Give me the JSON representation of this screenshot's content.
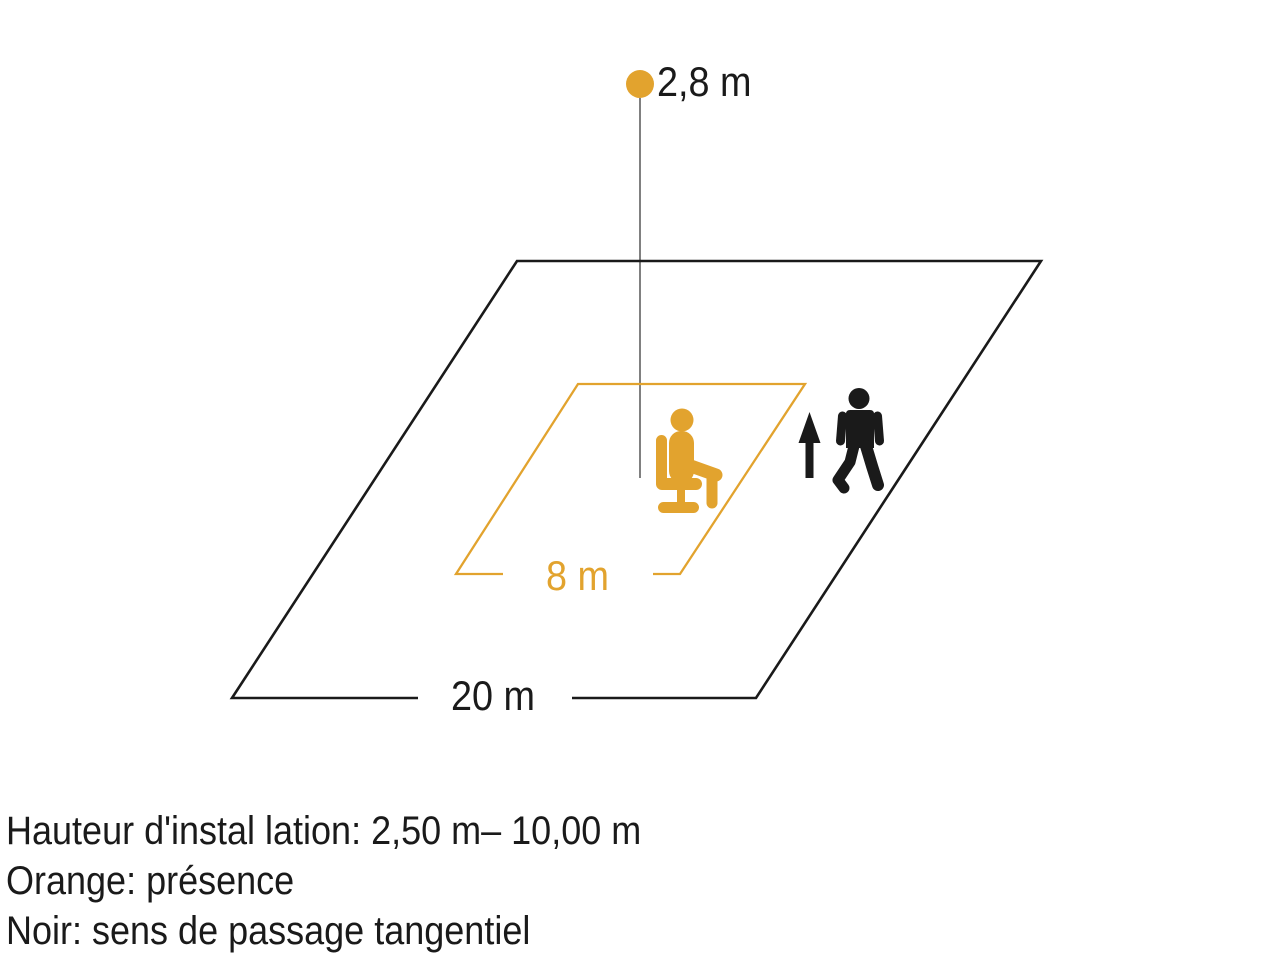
{
  "diagram": {
    "sensor_height_label": "2,8 m",
    "inner_zone_label": "8 m",
    "outer_zone_label": "20 m",
    "icons": [
      {
        "name": "seated-person-icon",
        "meaning": "présence",
        "color": "#E2A32E"
      },
      {
        "name": "walking-person-icon",
        "meaning": "sens de passage tangentiel",
        "color": "#1A1A1A"
      },
      {
        "name": "direction-arrow-icon",
        "meaning": "sens de passage",
        "color": "#1A1A1A"
      }
    ],
    "colors": {
      "orange": "#E2A32E",
      "black": "#1A1A1A",
      "plumb_line": "#4A4A4A",
      "background": "#FFFFFF"
    }
  },
  "legend": {
    "line1": "Hauteur d'instal lation: 2,50 m– 10,00 m",
    "line2": "Orange: présence",
    "line3": "Noir: sens de passage tangentiel"
  }
}
